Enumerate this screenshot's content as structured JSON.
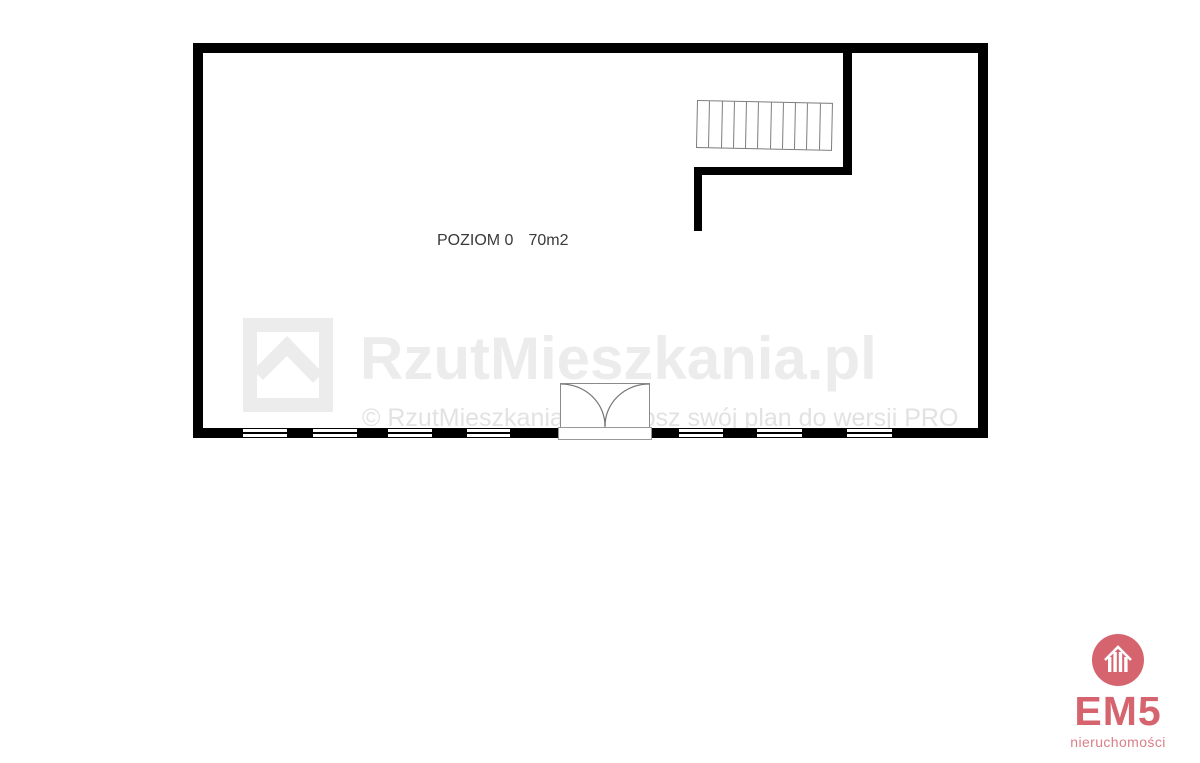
{
  "floor_plan": {
    "level_label": "POZIOM 0",
    "area_label": "70m2",
    "wall_color": "#000000",
    "stair_tread_count": 11,
    "window_count": 7
  },
  "watermark": {
    "brand_text": "RzutMieszkania.pl",
    "copyright_text": "© RzutMieszkania.pl. Ulepsz swój plan do wersji PRO",
    "color": "#ececec"
  },
  "branding": {
    "name": "EM5",
    "subtitle": "nieruchomości",
    "accent_color": "#d5646e",
    "subtitle_color": "#db7e87"
  }
}
